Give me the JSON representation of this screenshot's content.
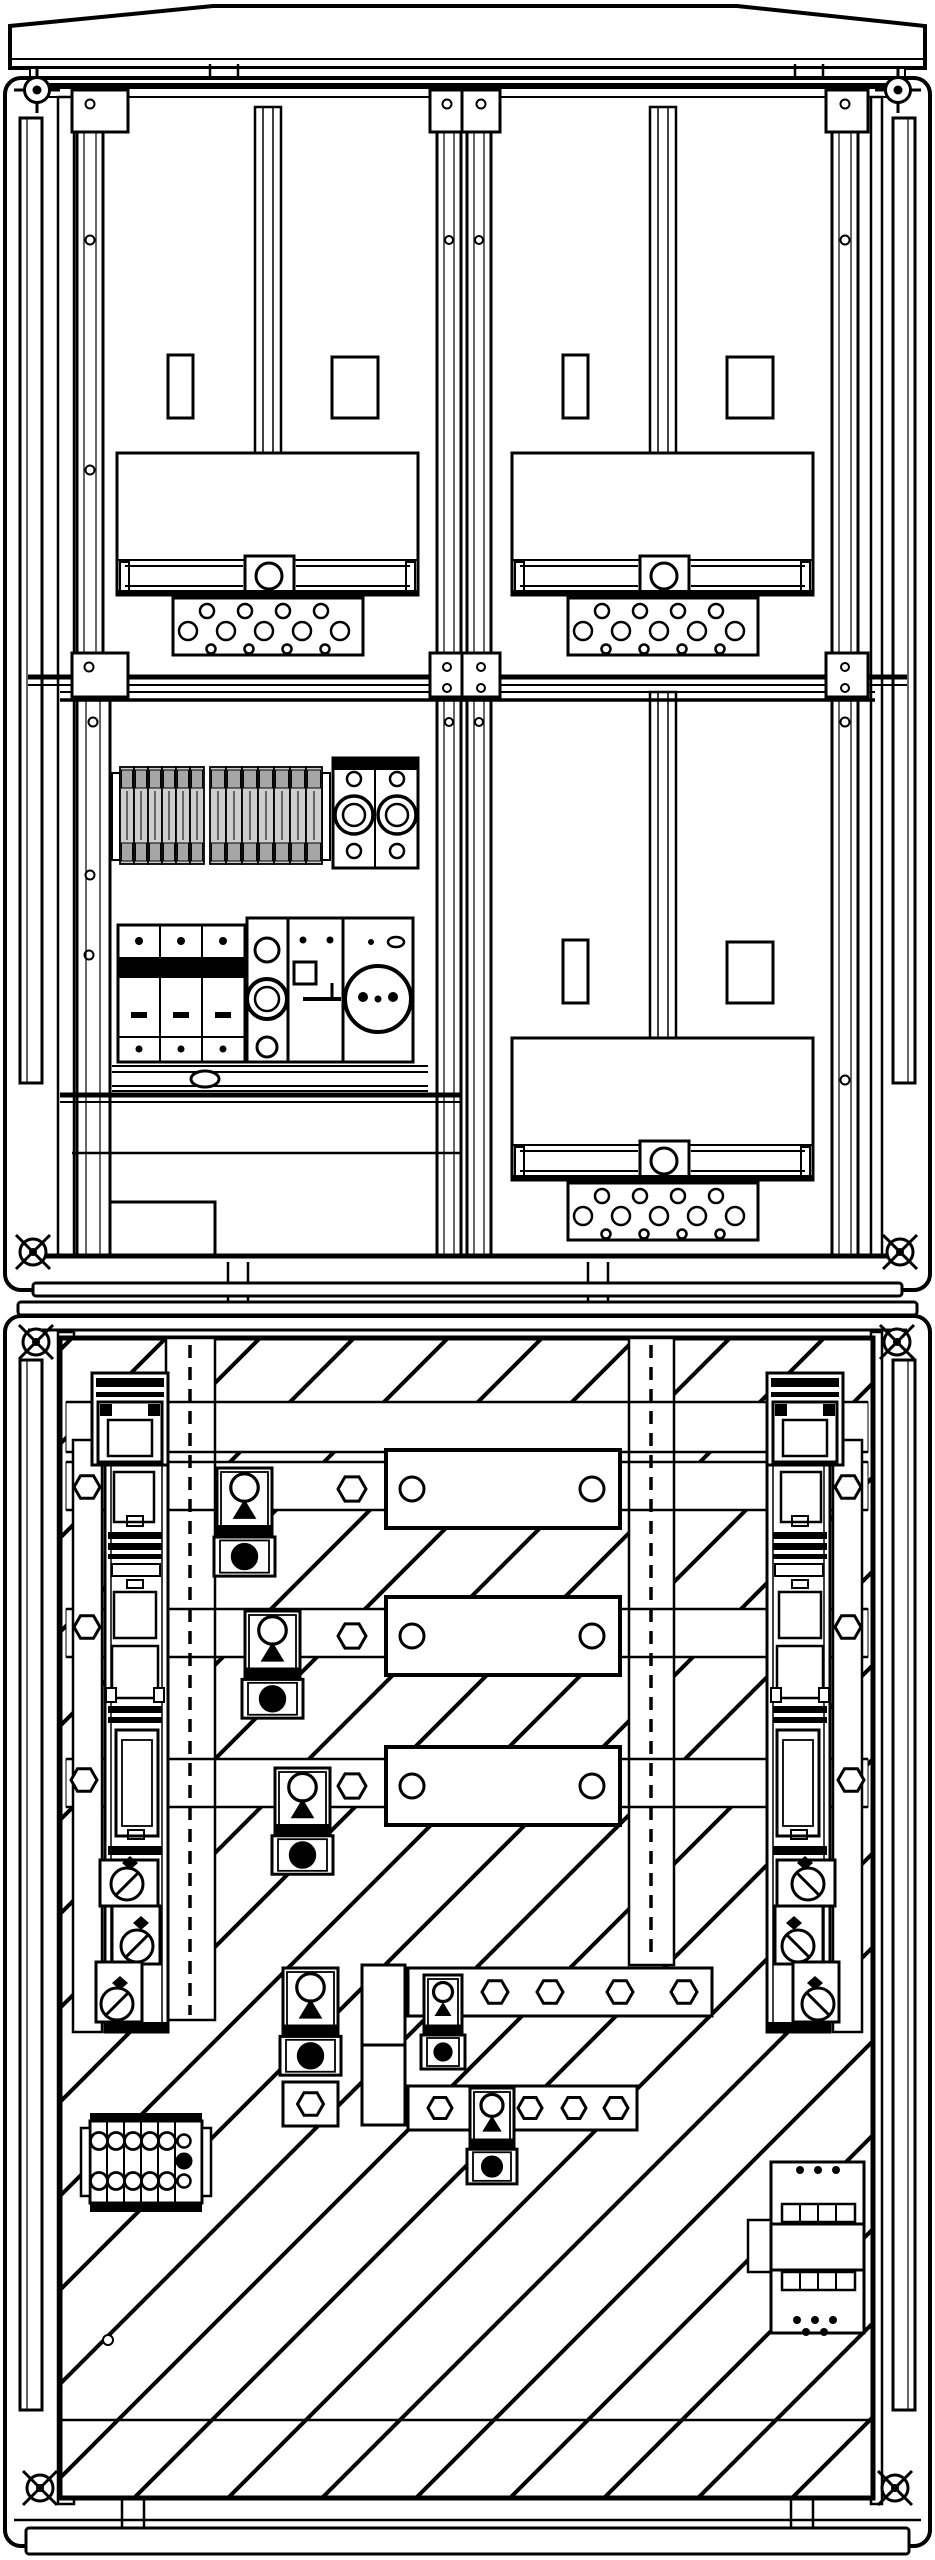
{
  "title": "Meter and cable-distribution cabinet - front view technical line drawing",
  "drawing_type": "black and white technical diagram, no text labels",
  "colors": {
    "line": "#000000",
    "background": "#ffffff",
    "module_fill": "#cdcdcd",
    "module_band": "#a6a6a6"
  },
  "upper_cabinet": {
    "label": "meter section",
    "meter_fields": [
      {
        "id": "meter-field-upper-left",
        "dx": 0,
        "dy": 0
      },
      {
        "id": "meter-field-upper-right",
        "dx": 395,
        "dy": 0
      },
      {
        "id": "meter-field-lower-right",
        "dx": 395,
        "dy": 585
      }
    ],
    "perforated_plate_hole_rows": [
      {
        "y": 611,
        "r": 7,
        "xs": [
          207,
          245,
          283,
          321
        ]
      },
      {
        "y": 631,
        "r": 9,
        "xs": [
          188,
          226,
          264,
          302,
          340
        ]
      },
      {
        "y": 649,
        "r": 4.5,
        "xs": [
          211,
          249,
          287,
          325
        ]
      }
    ],
    "terminal_modules": {
      "y": 767,
      "h": 97,
      "groups": [
        {
          "x": 120,
          "count": 6,
          "w": 14
        },
        {
          "x": 210,
          "count": 7,
          "w": 16
        }
      ]
    },
    "equipment": [
      "din-terminal-row",
      "sealing-terminal-block",
      "three-pole-fuse-switch",
      "main-switch",
      "control-switch",
      "schuko-socket"
    ]
  },
  "lower_cabinet": {
    "label": "cable connection section with hatched back panel",
    "busbar_bands": [
      [
        1402,
        50
      ],
      [
        1462,
        48
      ],
      [
        1609,
        48
      ],
      [
        1759,
        48
      ]
    ],
    "busbar_plates": {
      "x": 386,
      "w": 234,
      "h": 78,
      "rows": [
        1450,
        1597,
        1747
      ],
      "hole_dx": [
        26,
        206
      ],
      "hole_r": 12,
      "hex_x": 352,
      "hex_r": 14
    },
    "fuse_strip_hexes": [
      {
        "x": 87,
        "y": 1487,
        "r": 13
      },
      {
        "x": 128,
        "y": 1487,
        "r": 11
      },
      {
        "x": 87,
        "y": 1627,
        "r": 13
      },
      {
        "x": 84,
        "y": 1780,
        "r": 13
      }
    ],
    "fuse_modules": [
      {
        "x": 217,
        "y": 1468,
        "w": 55,
        "h": 115
      },
      {
        "x": 245,
        "y": 1611,
        "w": 55,
        "h": 114
      },
      {
        "x": 275,
        "y": 1768,
        "w": 55,
        "h": 113
      },
      {
        "x": 283,
        "y": 1968,
        "w": 55,
        "h": 114,
        "hex_below": true
      },
      {
        "x": 424,
        "y": 1975,
        "w": 38,
        "h": 100
      },
      {
        "x": 470,
        "y": 2088,
        "w": 44,
        "h": 102
      }
    ],
    "bus_row_a": {
      "x": 408,
      "y": 1968,
      "w": 304,
      "h": 48,
      "hex_xs": [
        495,
        550,
        620,
        684
      ],
      "hex_r": 13
    },
    "bus_row_b": {
      "x": 408,
      "y": 2086,
      "w": 229,
      "h": 44,
      "hex_xs": [
        440,
        530,
        574,
        616
      ],
      "hex_r": 12
    },
    "terminal_block": {
      "col_xs": [
        99,
        116,
        133,
        150,
        167
      ],
      "row_ys": [
        2141,
        2181
      ],
      "hole_r": 8.5,
      "aux": {
        "x": 184,
        "open_ys": [
          2141,
          2181
        ],
        "open_r": 6.5,
        "filled_y": 2161,
        "filled_r": 8
      }
    }
  }
}
